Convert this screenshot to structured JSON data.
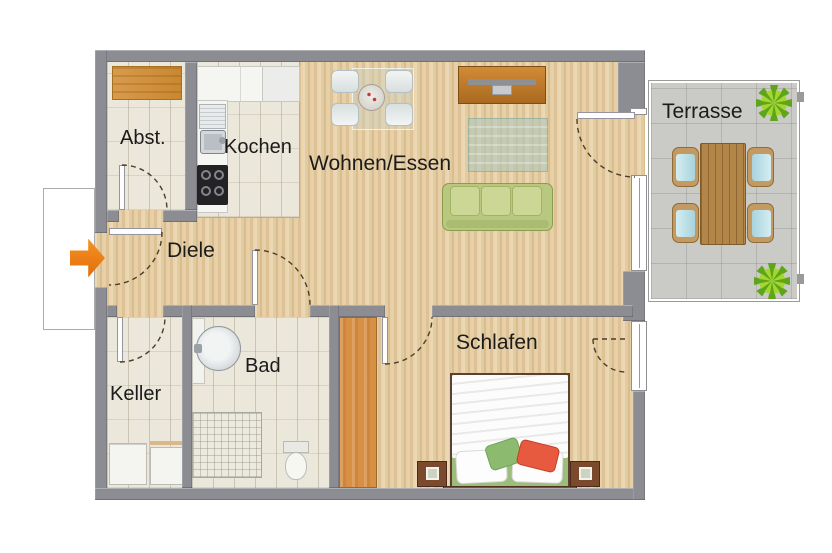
{
  "rooms": {
    "abst": {
      "label": "Abst."
    },
    "kochen": {
      "label": "Kochen"
    },
    "wohnen": {
      "label": "Wohnen/Essen"
    },
    "diele": {
      "label": "Diele"
    },
    "keller": {
      "label": "Keller"
    },
    "bad": {
      "label": "Bad"
    },
    "schlafen": {
      "label": "Schlafen"
    },
    "terrasse": {
      "label": "Terrasse"
    }
  },
  "icons": {
    "entrance_arrow": "block-arrow-right",
    "plant": "starburst-plant",
    "door_swing": "dashed-quarter-arc"
  },
  "colors": {
    "wall": "#8c8d93",
    "wood_floor": "#e4cb9e",
    "tile_floor": "#ebe7da",
    "terrace_floor": "#cacac6",
    "entrance_arrow": "#ef7d12",
    "sofa_green": "#c3d18d",
    "wardrobe_orange": "#d79044",
    "shelf_orange": "#d49245",
    "plant_green": "#5ea51c",
    "bed_pillow_green": "#8cbb70",
    "bed_pillow_red": "#e85a40"
  }
}
